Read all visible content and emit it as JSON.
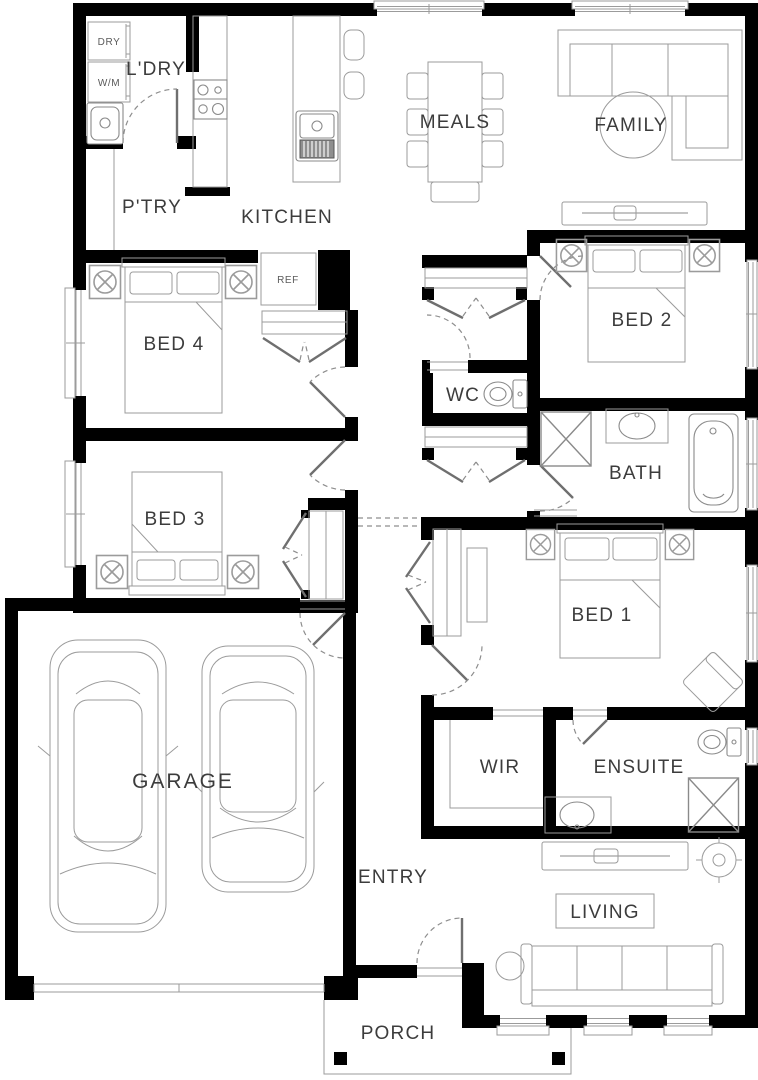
{
  "plan": {
    "title": "Single storey house floor plan",
    "colors": {
      "wall": "#000000",
      "furniture_line": "#9b9b9b",
      "door_line": "#6f6f6f",
      "label": "#3c3c3c",
      "background": "#ffffff"
    },
    "rooms": {
      "laundry": "L'DRY",
      "pantry": "P'TRY",
      "kitchen": "KITCHEN",
      "meals": "MEALS",
      "family": "FAMILY",
      "bed4": "BED 4",
      "bed2": "BED 2",
      "wc": "WC",
      "bath": "BATH",
      "bed3": "BED 3",
      "bed1": "BED 1",
      "garage": "GARAGE",
      "wir": "WIR",
      "ensuite": "ENSUITE",
      "entry": "ENTRY",
      "living": "LIVING",
      "porch": "PORCH"
    },
    "appliances": {
      "dryer": "DRY",
      "washer": "W/M",
      "fridge": "REF"
    }
  }
}
